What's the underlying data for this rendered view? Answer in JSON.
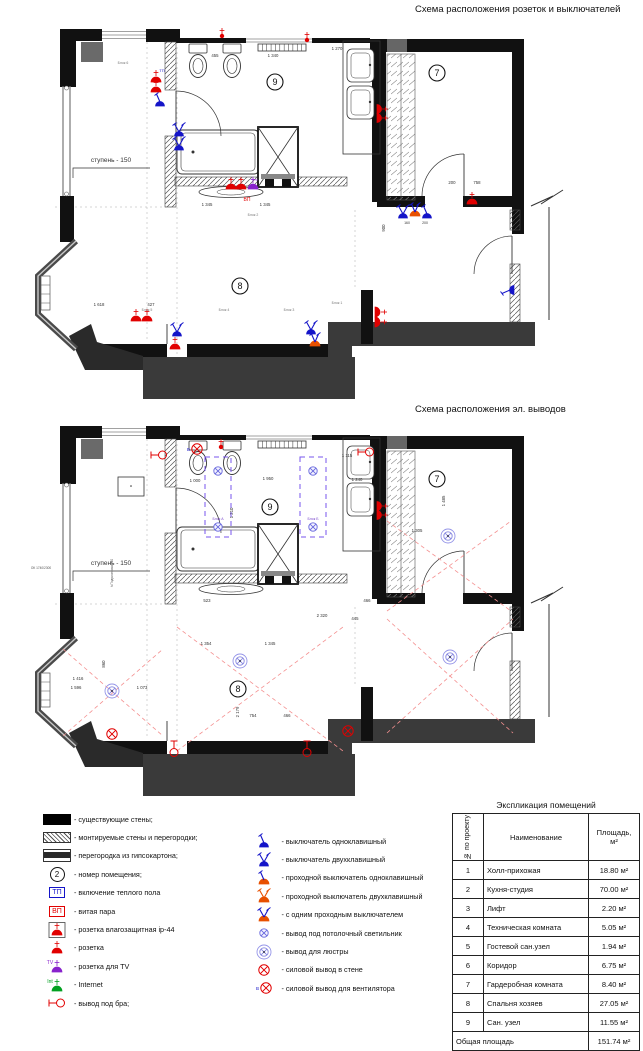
{
  "titles": {
    "plan1": "Схема расположения розеток и выключателей",
    "plan2": "Схема расположения эл. выводов"
  },
  "icons": {
    "fan_prefix": "В",
    "tv": "TV",
    "internet": "Int"
  },
  "plan1": {
    "rooms": [
      {
        "n": "9",
        "x": 250,
        "y": 58
      },
      {
        "n": "7",
        "x": 412,
        "y": 49
      },
      {
        "n": "8",
        "x": 215,
        "y": 262
      }
    ],
    "texts": [
      {
        "t": "ступень - 150",
        "x": 86,
        "y": 138,
        "s": 6.5
      },
      {
        "t": "1 340",
        "x": 248,
        "y": 33
      },
      {
        "t": "455",
        "x": 190,
        "y": 33
      },
      {
        "t": "1 270",
        "x": 312,
        "y": 26
      },
      {
        "t": "1 345",
        "x": 182,
        "y": 182
      },
      {
        "t": "1 345",
        "x": 240,
        "y": 182
      },
      {
        "t": "ВП",
        "x": 222,
        "y": 177,
        "s": 5,
        "c": "#e10000"
      },
      {
        "t": "ТП",
        "x": 137,
        "y": 48,
        "s": 4,
        "c": "#1414c8"
      },
      {
        "t": "TV",
        "x": 231,
        "y": 157,
        "s": 3,
        "c": "#8822cc"
      },
      {
        "t": "Блок 6",
        "x": 98,
        "y": 40,
        "s": 3.5,
        "c": "#777"
      },
      {
        "t": "Блок 2",
        "x": 228,
        "y": 192,
        "s": 3.5,
        "c": "#777"
      },
      {
        "t": "Блок 5",
        "x": 122,
        "y": 287,
        "s": 3.5,
        "c": "#777"
      },
      {
        "t": "Блок 4",
        "x": 199,
        "y": 287,
        "s": 3.5,
        "c": "#777"
      },
      {
        "t": "Блок 3",
        "x": 264,
        "y": 287,
        "s": 3.5,
        "c": "#777"
      },
      {
        "t": "Блок 1",
        "x": 312,
        "y": 280,
        "s": 3.5,
        "c": "#777"
      },
      {
        "t": "1 618",
        "x": 74,
        "y": 282
      },
      {
        "t": "427",
        "x": 126,
        "y": 282
      },
      {
        "t": "200",
        "x": 427,
        "y": 160
      },
      {
        "t": "758",
        "x": 452,
        "y": 160
      },
      {
        "t": "900",
        "x": 360,
        "y": 204,
        "r": -90
      },
      {
        "t": "160",
        "x": 382,
        "y": 200,
        "s": 3.5
      },
      {
        "t": "200",
        "x": 400,
        "y": 200,
        "s": 3.5
      }
    ],
    "symbols": [
      {
        "k": "dot",
        "x": 197,
        "y": 12
      },
      {
        "k": "dot",
        "x": 282,
        "y": 16
      },
      {
        "k": "socket",
        "x": 131,
        "y": 58
      },
      {
        "k": "socket",
        "x": 131,
        "y": 68
      },
      {
        "k": "sw1",
        "x": 135,
        "y": 82
      },
      {
        "k": "sw2",
        "x": 154,
        "y": 112
      },
      {
        "k": "sw2",
        "x": 154,
        "y": 126
      },
      {
        "k": "socket2",
        "x": 352,
        "y": 90,
        "r": 90
      },
      {
        "k": "socket",
        "x": 447,
        "y": 180
      },
      {
        "k": "sw1",
        "x": 489,
        "y": 266,
        "r": -90
      },
      {
        "k": "prox",
        "x": 390,
        "y": 192
      },
      {
        "k": "sw2",
        "x": 378,
        "y": 194
      },
      {
        "k": "sw1",
        "x": 402,
        "y": 194
      },
      {
        "k": "socket",
        "x": 206,
        "y": 165
      },
      {
        "k": "socket",
        "x": 216,
        "y": 165
      },
      {
        "k": "tv",
        "x": 228,
        "y": 165
      },
      {
        "k": "socket",
        "x": 111,
        "y": 297
      },
      {
        "k": "socket",
        "x": 122,
        "y": 297
      },
      {
        "k": "sw2",
        "x": 152,
        "y": 312
      },
      {
        "k": "socket",
        "x": 150,
        "y": 325
      },
      {
        "k": "sw2",
        "x": 286,
        "y": 310
      },
      {
        "k": "prox",
        "x": 290,
        "y": 322
      },
      {
        "k": "socket",
        "x": 350,
        "y": 288,
        "r": 90
      },
      {
        "k": "socket",
        "x": 350,
        "y": 298,
        "r": 90
      }
    ],
    "crosses": [],
    "prects": []
  },
  "plan2": {
    "rooms": [
      {
        "n": "9",
        "x": 245,
        "y": 86
      },
      {
        "n": "7",
        "x": 412,
        "y": 58
      },
      {
        "n": "8",
        "x": 213,
        "y": 268
      }
    ],
    "texts": [
      {
        "t": "ступень - 150",
        "x": 86,
        "y": 144,
        "s": 6.5
      },
      {
        "t": "1 000",
        "x": 170,
        "y": 61
      },
      {
        "t": "1 950",
        "x": 243,
        "y": 59
      },
      {
        "t": "1 115",
        "x": 322,
        "y": 36
      },
      {
        "t": "1 240",
        "x": 332,
        "y": 60
      },
      {
        "t": "1 210",
        "x": 208,
        "y": 92,
        "r": -90
      },
      {
        "t": "1 305",
        "x": 392,
        "y": 111
      },
      {
        "t": "1 485",
        "x": 420,
        "y": 80,
        "r": -90
      },
      {
        "t": "523",
        "x": 182,
        "y": 181
      },
      {
        "t": "2 320",
        "x": 297,
        "y": 196
      },
      {
        "t": "466",
        "x": 342,
        "y": 181
      },
      {
        "t": "445",
        "x": 330,
        "y": 199
      },
      {
        "t": "1 354",
        "x": 181,
        "y": 224
      },
      {
        "t": "1 345",
        "x": 245,
        "y": 224
      },
      {
        "t": "1 416",
        "x": 53,
        "y": 259
      },
      {
        "t": "1 596",
        "x": 51,
        "y": 268
      },
      {
        "t": "1 073",
        "x": 117,
        "y": 268
      },
      {
        "t": "860",
        "x": 80,
        "y": 243,
        "r": -90
      },
      {
        "t": "2 179",
        "x": 214,
        "y": 291,
        "r": -90
      },
      {
        "t": "754",
        "x": 228,
        "y": 296
      },
      {
        "t": "466",
        "x": 262,
        "y": 296
      },
      {
        "t": "Блок А",
        "x": 193,
        "y": 99,
        "s": 3.5,
        "c": "#7744cc"
      },
      {
        "t": "Блок Б",
        "x": 288,
        "y": 99,
        "s": 3.5,
        "c": "#7744cc"
      },
      {
        "t": "ОК 1740/2300",
        "x": 16,
        "y": 148,
        "s": 3.2,
        "c": "#555"
      },
      {
        "t": "h Подоконника 760",
        "x": 88,
        "y": 152,
        "s": 3.2,
        "c": "#555",
        "r": -90
      }
    ],
    "symbols": [
      {
        "k": "fan",
        "x": 172,
        "y": 28
      },
      {
        "k": "dot",
        "x": 196,
        "y": 26
      },
      {
        "k": "bra",
        "x": 134,
        "y": 34
      },
      {
        "k": "bra",
        "x": 341,
        "y": 31
      },
      {
        "k": "ceil",
        "x": 193,
        "y": 50
      },
      {
        "k": "ceil",
        "x": 193,
        "y": 106
      },
      {
        "k": "ceil",
        "x": 288,
        "y": 50
      },
      {
        "k": "ceil",
        "x": 288,
        "y": 106
      },
      {
        "k": "chand",
        "x": 87,
        "y": 270
      },
      {
        "k": "chand",
        "x": 215,
        "y": 240
      },
      {
        "k": "chand",
        "x": 423,
        "y": 115
      },
      {
        "k": "chand",
        "x": 425,
        "y": 236
      },
      {
        "k": "pwall",
        "x": 87,
        "y": 313
      },
      {
        "k": "pwall",
        "x": 323,
        "y": 310
      },
      {
        "k": "bra",
        "x": 149,
        "y": 328,
        "r": 90
      },
      {
        "k": "bra",
        "x": 282,
        "y": 328,
        "r": 90
      },
      {
        "k": "socket2",
        "x": 352,
        "y": 90,
        "r": 90
      }
    ],
    "crosses": [
      {
        "x1": 38,
        "y1": 228,
        "x2": 138,
        "y2": 315
      },
      {
        "x1": 38,
        "y1": 315,
        "x2": 138,
        "y2": 228
      },
      {
        "x1": 152,
        "y1": 206,
        "x2": 318,
        "y2": 330
      },
      {
        "x1": 152,
        "y1": 330,
        "x2": 318,
        "y2": 206
      },
      {
        "x1": 362,
        "y1": 100,
        "x2": 486,
        "y2": 190
      },
      {
        "x1": 362,
        "y1": 190,
        "x2": 486,
        "y2": 100
      },
      {
        "x1": 362,
        "y1": 198,
        "x2": 488,
        "y2": 312
      },
      {
        "x1": 362,
        "y1": 312,
        "x2": 488,
        "y2": 198
      }
    ],
    "prects": [
      {
        "x": 180,
        "y": 36,
        "w": 26,
        "h": 80
      },
      {
        "x": 275,
        "y": 36,
        "w": 26,
        "h": 80
      }
    ]
  },
  "legend": {
    "left": [
      {
        "icon": "wall-existing",
        "label": "- существующие стены;"
      },
      {
        "icon": "wall-mounted",
        "label": "- монтируемые стены и перегородки;"
      },
      {
        "icon": "wall-drywall",
        "label": "- перегородка из гипсокартона;"
      },
      {
        "icon": "room-number",
        "icon_text": "2",
        "label": "- номер помещения;"
      },
      {
        "icon": "tp-box",
        "icon_text": "ТП",
        "label": "- включение теплого пола"
      },
      {
        "icon": "vp-box",
        "icon_text": "ВП",
        "label": "- витая пара"
      },
      {
        "icon": "socket-ip44",
        "label": "- розетка влагозащитная ip-44"
      },
      {
        "icon": "socket",
        "label": "- розетка"
      },
      {
        "icon": "socket-tv",
        "label": "- розетка для TV"
      },
      {
        "icon": "socket-internet",
        "label": "- Internet"
      },
      {
        "icon": "bra-output",
        "label": "- вывод под бра;"
      }
    ],
    "right": [
      {
        "icon": "switch-1",
        "label": "- выключатель одноклавишный"
      },
      {
        "icon": "switch-2",
        "label": "- выключатель двухклавишный"
      },
      {
        "icon": "pass-switch-1",
        "label": "- проходной выключатель одноклавишный"
      },
      {
        "icon": "pass-switch-2",
        "label": "- проходной выключатель двухклавишный"
      },
      {
        "icon": "switch-mixed",
        "label": "- с одним проходным выключателем"
      },
      {
        "icon": "ceiling-light",
        "label": "- вывод под потолочный светильник"
      },
      {
        "icon": "chandelier",
        "label": "- вывод для люстры"
      },
      {
        "icon": "power-wall",
        "label": "- силовой вывод в стене"
      },
      {
        "icon": "fan-output",
        "label": "- силовой вывод для вентилятора"
      }
    ]
  },
  "table": {
    "title": "Экспликация помещений",
    "headers": [
      "№ по проекту",
      "Наименование",
      "Площадь, м²"
    ],
    "rows": [
      [
        "1",
        "Холл-прихожая",
        "18.80 м²"
      ],
      [
        "2",
        "Кухня-студия",
        "70.00 м²"
      ],
      [
        "3",
        "Лифт",
        "2.20 м²"
      ],
      [
        "4",
        "Техническая комната",
        "5.05 м²"
      ],
      [
        "5",
        "Гостевой сан.узел",
        "1.94 м²"
      ],
      [
        "6",
        "Коридор",
        "6.75 м²"
      ],
      [
        "7",
        "Гардеробная комната",
        "8.40 м²"
      ],
      [
        "8",
        "Спальня хозяев",
        "27.05 м²"
      ],
      [
        "9",
        "Сан. узел",
        "11.55 м²"
      ]
    ],
    "total": [
      "Общая площадь",
      "151.74 м²"
    ]
  }
}
